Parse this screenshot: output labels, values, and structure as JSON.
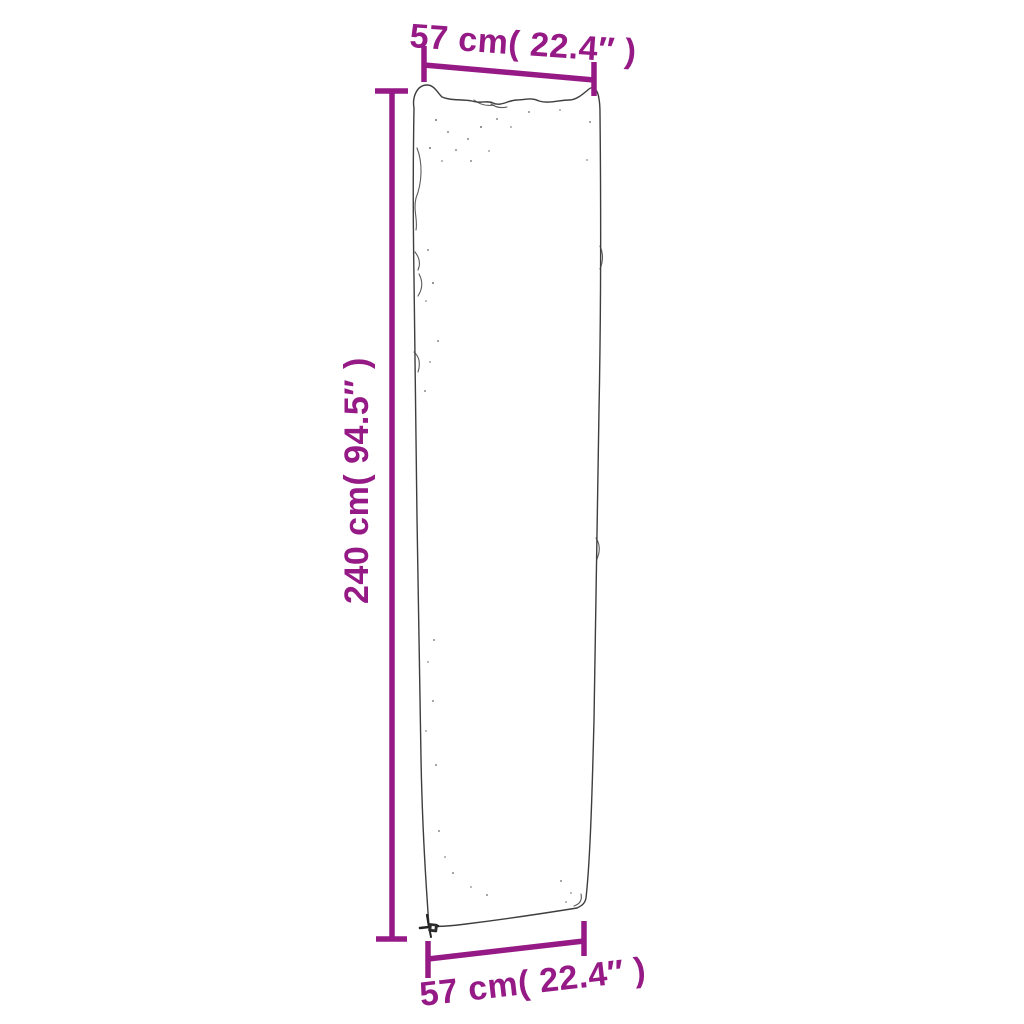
{
  "colors": {
    "dimension": "#951a86",
    "outline": "#3e3e3e",
    "speckle": "#8a8a8a",
    "background": "#ffffff"
  },
  "diagram": {
    "kind": "product-dimension-diagram",
    "dimensions": {
      "top_width": {
        "label": "57 cm( 22.4″ )",
        "value_cm": 57,
        "value_in": 22.4
      },
      "height": {
        "label": "240 cm( 94.5″ )",
        "value_cm": 240,
        "value_in": 94.5
      },
      "bottom_width": {
        "label": "57 cm( 22.4″ )",
        "value_cm": 57,
        "value_in": 22.4
      }
    }
  }
}
